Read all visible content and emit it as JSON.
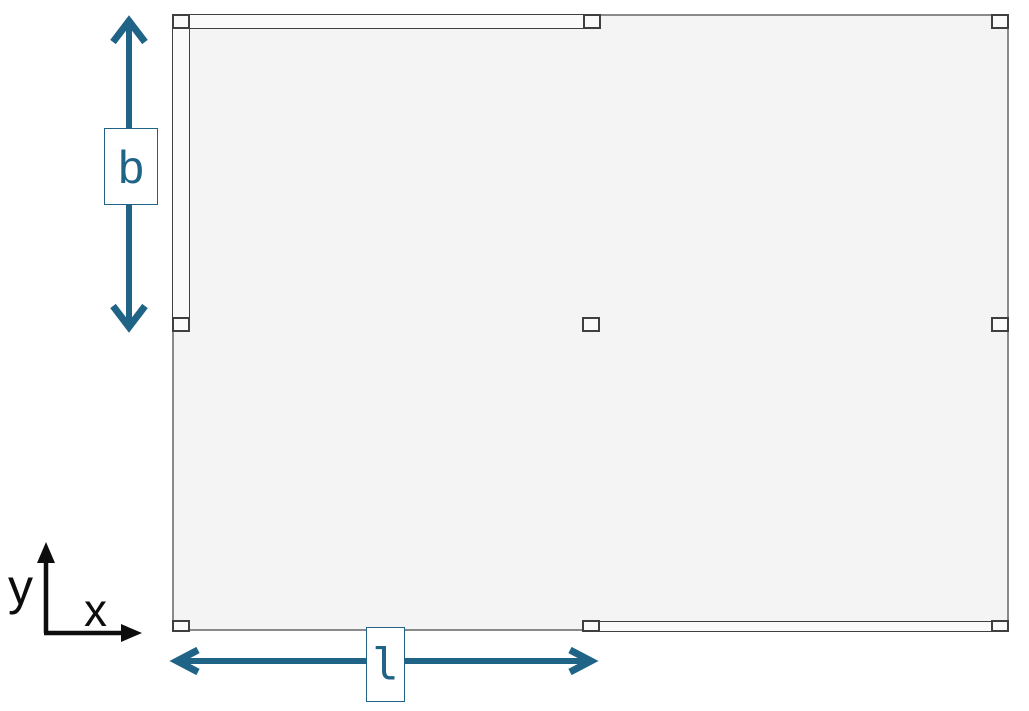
{
  "diagram": {
    "labels": {
      "width_dimension": "b",
      "length_dimension": "l",
      "axis_x": "x",
      "axis_y": "y"
    },
    "colors": {
      "accent": "#1f6387",
      "plate-fill": "#f4f4f4",
      "plate-border": "#8a8a8a",
      "support-border": "#3f3f3f",
      "support-fill": "#fafafa",
      "axis-color": "#0d0d0d",
      "background": "#ffffff"
    }
  }
}
